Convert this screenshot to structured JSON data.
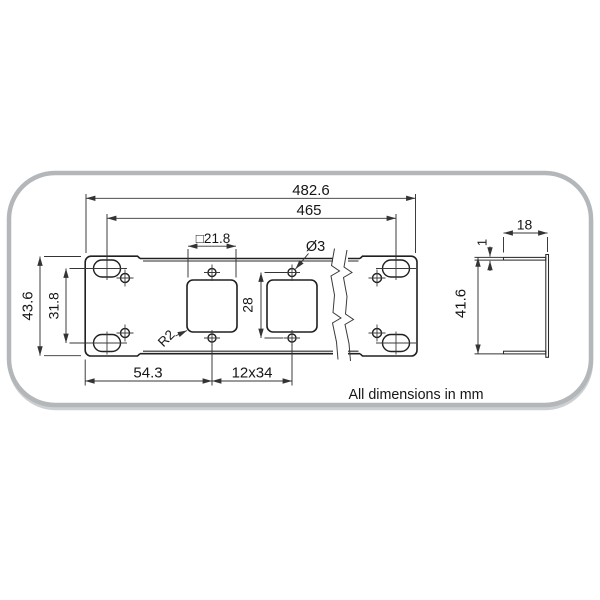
{
  "drawing": {
    "type": "technical-drawing",
    "subject": "19-inch rack mount keystone patch panel bracket, front view with break lines and side profile view",
    "units_note": "All dimensions in mm",
    "labels": {
      "overall_width": "482.6",
      "mounting_slot_span": "465",
      "cutout_size": "□21.8",
      "hole_diameter": "Ø3",
      "overall_height": "43.6",
      "slot_vertical_spacing": "31.8",
      "hole_vertical_spacing": "28",
      "first_cutout_offset": "54.3",
      "cutout_pitch": "12x34",
      "corner_radius": "R2",
      "flange_depth": "18",
      "material_thickness": "1",
      "flange_height": "41.6"
    }
  }
}
